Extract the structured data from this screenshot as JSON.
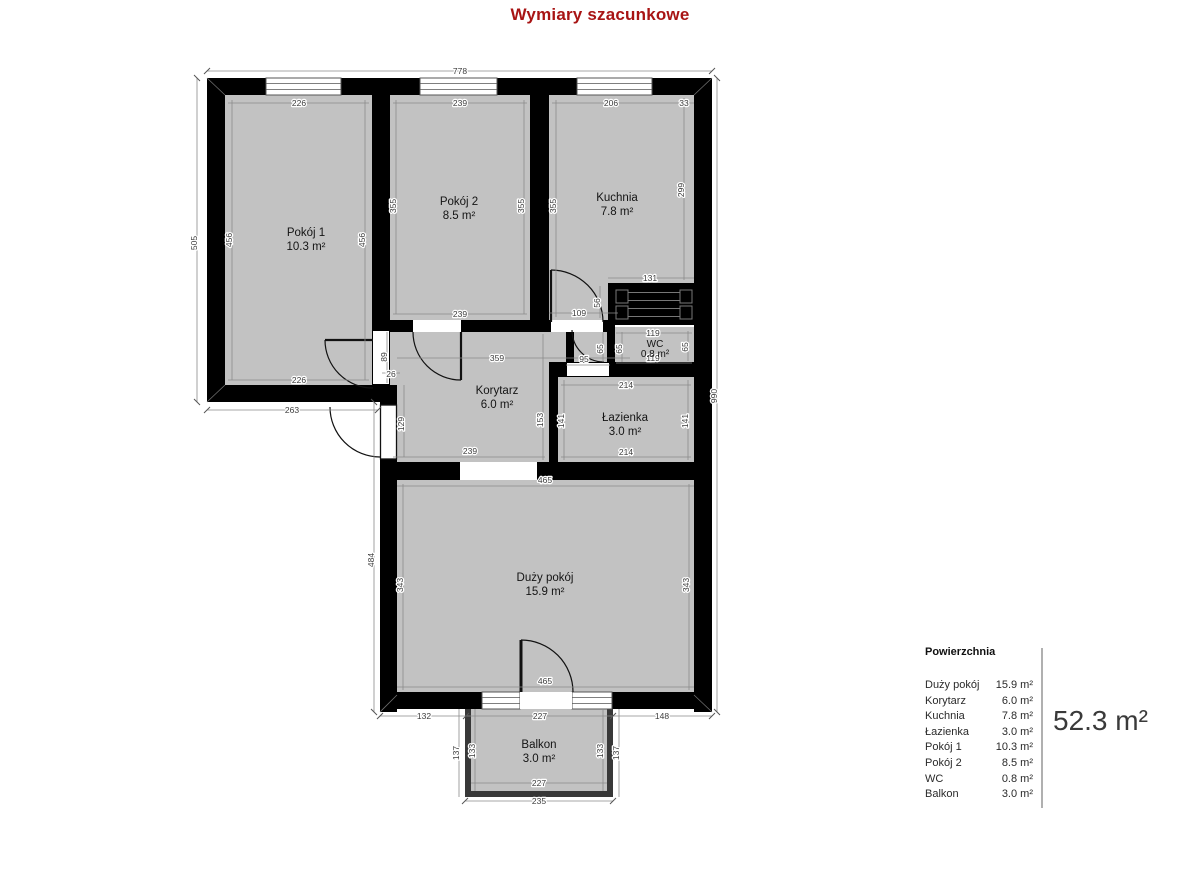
{
  "title": "Wymiary szacunkowe",
  "colors": {
    "title": "#a81414",
    "walls": "#000000",
    "room_fill": "#c2c2c2",
    "dim_line": "#8a8a8a",
    "dim_text": "#3c3c3c",
    "total_text": "#3a3a3a"
  },
  "rooms": {
    "pokoj1": {
      "name": "Pokój 1",
      "area": "10.3 m²"
    },
    "pokoj2": {
      "name": "Pokój 2",
      "area": "8.5 m²"
    },
    "kuchnia": {
      "name": "Kuchnia",
      "area": "7.8 m²"
    },
    "wc": {
      "name": "WC",
      "area": "0.8 m²"
    },
    "korytarz": {
      "name": "Korytarz",
      "area": "6.0 m²"
    },
    "lazienka": {
      "name": "Łazienka",
      "area": "3.0 m²"
    },
    "duzy_pokoj": {
      "name": "Duży pokój",
      "area": "15.9 m²"
    },
    "balkon": {
      "name": "Balkon",
      "area": "3.0 m²"
    }
  },
  "dims": {
    "d778": "778",
    "d505": "505",
    "d263": "263",
    "d226t": "226",
    "d226b": "226",
    "d456l": "456",
    "d456r": "456",
    "d239t": "239",
    "d239b": "239",
    "d355a": "355",
    "d355b": "355",
    "d355c": "355",
    "d206": "206",
    "d33": "33",
    "d299": "299",
    "d131": "131",
    "d56": "56",
    "d109": "109",
    "d359": "359",
    "d89": "89",
    "d26": "26",
    "d129": "129",
    "d119t": "119",
    "d119b": "119",
    "d65a": "65",
    "d65b": "65",
    "d65c": "65",
    "d95": "95",
    "d214t": "214",
    "d214b": "214",
    "d141l": "141",
    "d141r": "141",
    "d153": "153",
    "d239k": "239",
    "d465t": "465",
    "d465b": "465",
    "d343l": "343",
    "d343r": "343",
    "d484": "484",
    "d990": "990",
    "d132": "132",
    "d227m": "227",
    "d148": "148",
    "d137l": "137",
    "d133l": "133",
    "d133r": "133",
    "d137r": "137",
    "d227b": "227",
    "d235": "235"
  },
  "legend": {
    "heading": "Powierzchnia",
    "items": [
      {
        "name": "Duży pokój",
        "area": "15.9 m²"
      },
      {
        "name": "Korytarz",
        "area": "6.0 m²"
      },
      {
        "name": "Kuchnia",
        "area": "7.8 m²"
      },
      {
        "name": "Łazienka",
        "area": "3.0 m²"
      },
      {
        "name": "Pokój 1",
        "area": "10.3 m²"
      },
      {
        "name": "Pokój 2",
        "area": "8.5 m²"
      },
      {
        "name": "WC",
        "area": "0.8 m²"
      },
      {
        "name": "Balkon",
        "area": "3.0 m²"
      }
    ],
    "total": "52.3 m²"
  }
}
